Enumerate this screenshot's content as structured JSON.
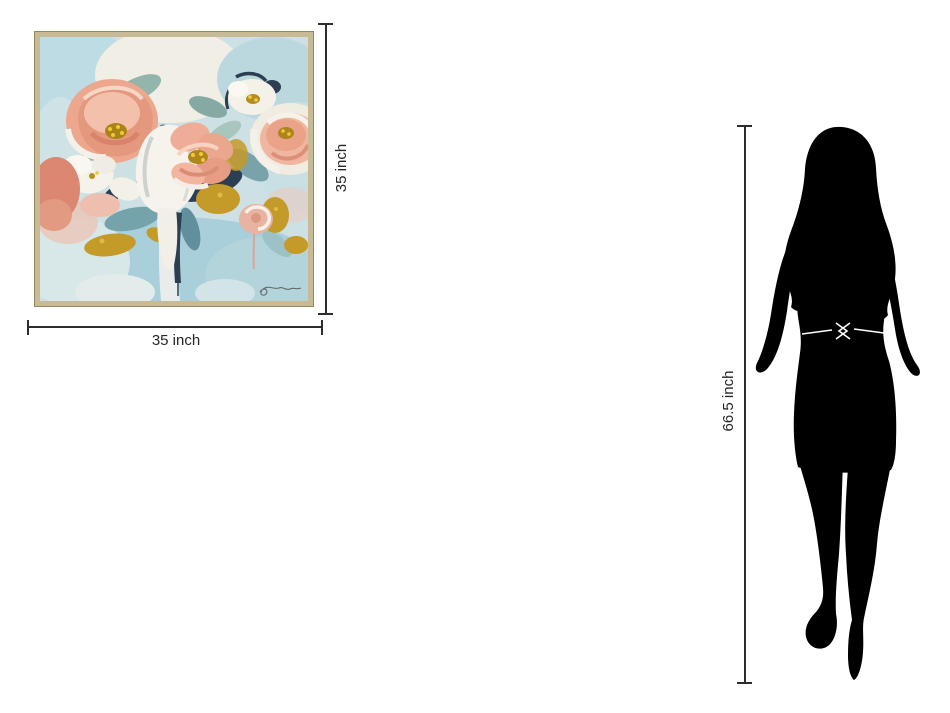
{
  "page": {
    "background_color": "#ffffff",
    "description": "product-size-comparison-diagram"
  },
  "artwork": {
    "item": "floral-abstract-framed-canvas",
    "width_label": "35 inch",
    "height_label": "35 inch",
    "frame_color": "#c8ba94",
    "palette": {
      "light_blue": "#bedce3",
      "pink": "#eda78f",
      "coral": "#db8771",
      "cream_white": "#f4f1ea",
      "gold": "#c49a28",
      "navy": "#2c3e52",
      "sage": "#93b5ab"
    }
  },
  "reference_figure": {
    "item": "woman-silhouette",
    "height_label": "66.5 inch",
    "silhouette_color": "#000000"
  },
  "dimension_style": {
    "line_color": "#2d2d2d",
    "text_color": "#262626"
  }
}
